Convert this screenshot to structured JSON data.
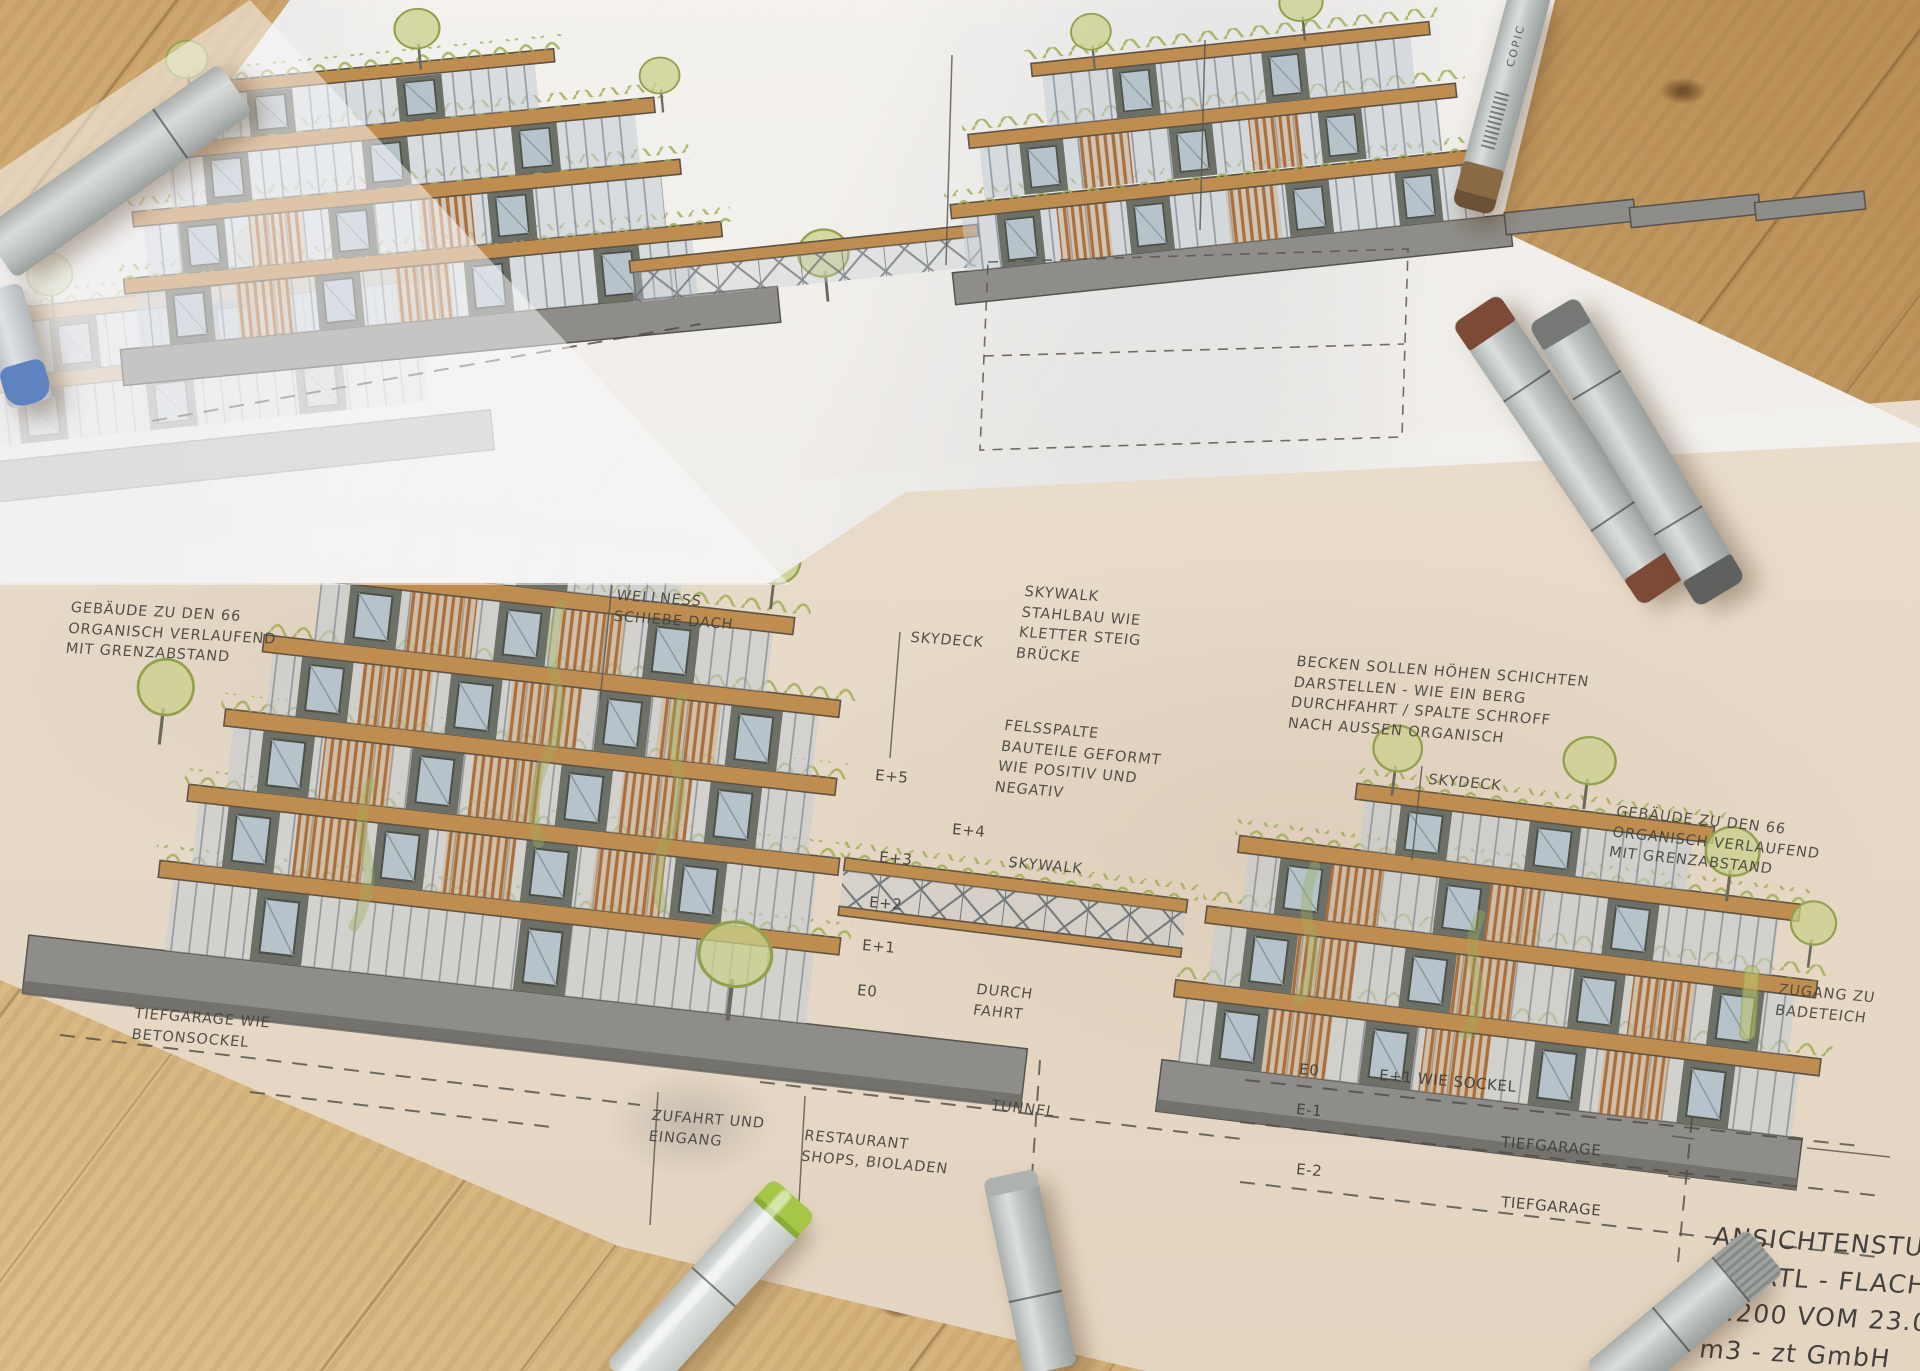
{
  "annotations": {
    "gebaeude_left": {
      "lines": [
        "GEBÄUDE ZU DEN 66",
        "ORGANISCH VERLAUFEND",
        "MIT GRENZABSTAND"
      ]
    },
    "wellness": {
      "lines": [
        "WELLNESS",
        "SCHIEBE DACH"
      ]
    },
    "skydeck_left": {
      "text": "SKYDECK"
    },
    "skywalk_note": {
      "lines": [
        "SKYWALK",
        "STAHLBAU WIE",
        "KLETTER STEIG",
        "BRÜCKE"
      ]
    },
    "becken_note": {
      "lines": [
        "BECKEN SOLLEN HÖHEN SCHICHTEN",
        "DARSTELLEN - WIE EIN BERG",
        "DURCHFAHRT / SPALTE SCHROFF",
        "NACH AUSSEN ORGANISCH"
      ]
    },
    "skydeck_right": {
      "text": "SKYDECK"
    },
    "felsspalte_note": {
      "lines": [
        "FELSSPALTE",
        "BAUTEILE GEFORMT",
        "WIE POSITIV UND",
        "NEGATIV"
      ]
    },
    "gebaeude_right": {
      "lines": [
        "GEBÄUDE ZU DEN 66",
        "ORGANISCH VERLAUFEND",
        "MIT GRENZABSTAND"
      ]
    },
    "skywalk_label": {
      "text": "SKYWALK"
    },
    "durchfahrt_label": {
      "lines": [
        "DURCH",
        "FAHRT"
      ]
    },
    "tiefgarage_note": {
      "lines": [
        "TIEFGARAGE WIE",
        "BETONSOCKEL"
      ]
    },
    "zufahrt_label": {
      "lines": [
        "ZUFAHRT UND",
        "EINGANG"
      ]
    },
    "restaurant_label": {
      "lines": [
        "RESTAURANT",
        "SHOPS, BIOLADEN"
      ]
    },
    "tunnel_label": {
      "text": "TUNNEL"
    },
    "zugang_label": {
      "lines": [
        "ZUGANG ZU",
        "BADETEICH"
      ]
    },
    "floor_labels_left": [
      "E+5",
      "E+4",
      "E+3",
      "E+2",
      "E+1",
      "E0"
    ],
    "levels_right": {
      "e0": "E0",
      "e1_wie_sockel": "E+1 WIE SOCKEL",
      "e_minus_1": "E-1",
      "tiefgarage_1": "TIEFGARAGE",
      "e_minus_2": "E-2",
      "tiefgarage_2": "TIEFGARAGE"
    }
  },
  "title_block": {
    "lines": [
      "ANSICHTENSTU",
      "HARTL - FLACH",
      "1:200 VOM 23.0",
      "m3 - zt GmbH"
    ]
  },
  "markers": {
    "brand_label": "COPIC",
    "items": [
      {
        "name": "marker-top-left-grey",
        "body_color": "#c3c7c6",
        "cap_color": "#b0b4b3"
      },
      {
        "name": "marker-left-blue-cap",
        "body_color": "#ced3d7",
        "cap_color": "#5f83c0"
      },
      {
        "name": "marker-top-right-copic",
        "body_color": "#cacecd",
        "cap_color": "#8a6a45"
      },
      {
        "name": "marker-right-brown-caps",
        "body_color": "#b7bcbb",
        "cap_color": "#7d4a35"
      },
      {
        "name": "marker-right-grey-caps",
        "body_color": "#b7bcbb",
        "cap_color": "#767875"
      },
      {
        "name": "marker-bottom-green-cap",
        "body_color": "#ccd0cd",
        "cap_color": "#a5c647"
      },
      {
        "name": "marker-bottom-center-grey",
        "body_color": "#c0c4c1",
        "cap_color": "#aeb2af"
      },
      {
        "name": "marker-bottom-right-ribbed-cap",
        "body_color": "#babeba",
        "cap_color": "#9fa3a0"
      }
    ]
  },
  "colors": {
    "wood_table": "#c79a60",
    "paper_top_sheet": "#f2f0ed",
    "paper_bottom_sheet": "#e8dccb",
    "pencil": "#55524c",
    "slab_wood": "#c08d50",
    "timber_slats": "#a96a36",
    "foliage_green": "#9fae54",
    "window_frame": "#6d7066",
    "glass": "#c2ccd2",
    "plinth_concrete": "#8e8d89"
  }
}
